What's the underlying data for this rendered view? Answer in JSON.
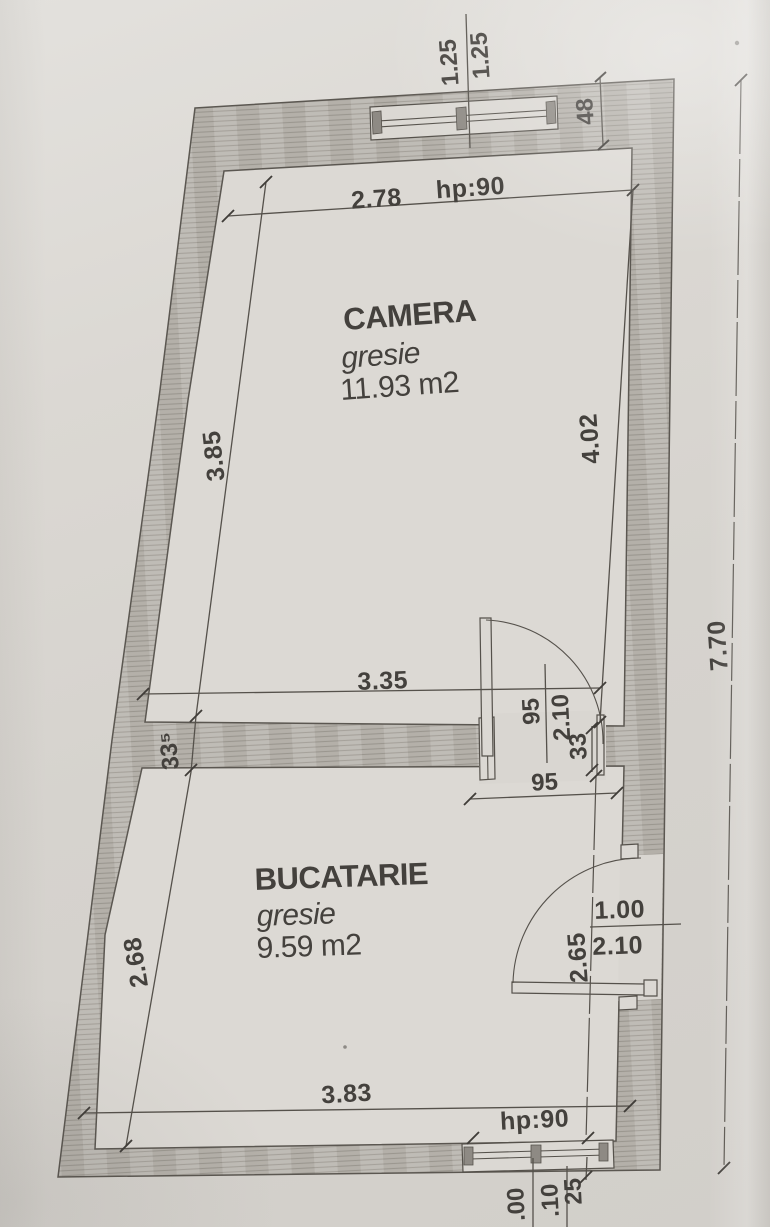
{
  "plan": {
    "rooms": [
      {
        "name": "CAMERA",
        "finish": "gresie",
        "area": "11.93 m2"
      },
      {
        "name": "BUCATARIE",
        "finish": "gresie",
        "area": "9.59 m2"
      }
    ],
    "dims": {
      "win_top_a": "1.25",
      "win_top_b": "1.25",
      "wall_corner": "48",
      "top_width": "2.78",
      "hp_top": "hp:90",
      "cam_left": "3.85",
      "cam_right": "4.02",
      "total_height": "7.70",
      "cam_width": "3.35",
      "wall_left_thk": "33⁵",
      "door1_w": "95",
      "door1_h": "2.10",
      "wall_right_thk": "33",
      "door1_open": "95",
      "buc_left": "2.68",
      "buc_right": "2.65",
      "door2_w": "1.00",
      "door2_h": "2.10",
      "buc_width": "3.83",
      "hp_bot": "hp:90",
      "level_a": ".00",
      "level_b": ".10",
      "level_c": "25"
    }
  },
  "colors": {
    "paper": "#d7d4cf",
    "wall_fill": "#bcb8b2",
    "wall_hatch": "#a19d96",
    "line": "#55514b",
    "text": "#44413d"
  }
}
